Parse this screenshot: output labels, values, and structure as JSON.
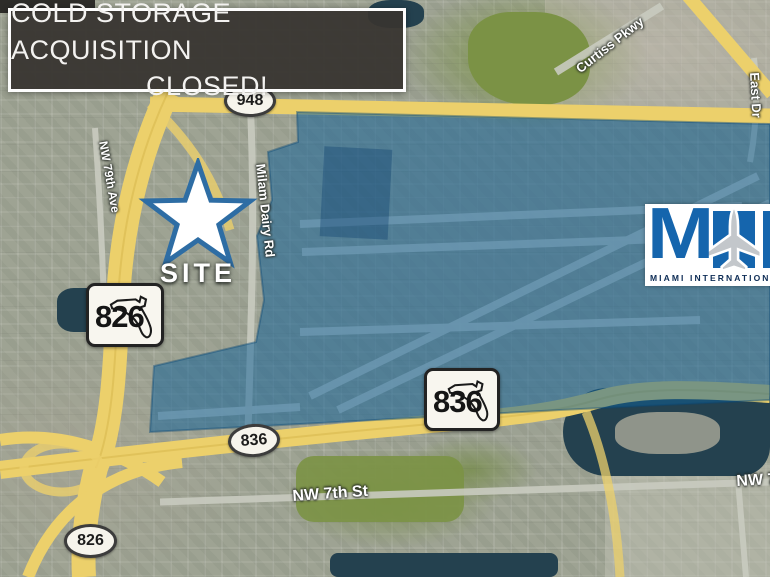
{
  "banner": {
    "line1": "COLD STORAGE ACQUISITION",
    "line2": "CLOSED!"
  },
  "site_marker": {
    "label": "SITE"
  },
  "shields": {
    "oval_948": "948",
    "florida_826": "826",
    "florida_836": "836",
    "oval_836": "836",
    "oval_826": "826"
  },
  "street_labels": {
    "milam_dairy_rd": "Milam Dairy Rd",
    "nw_79th_ave": "NW 79th Ave",
    "curtiss_pkwy": "Curtiss Pkwy",
    "east_dr": "East Dr",
    "nw_7th_st": "NW 7th St",
    "nw_7th_st_right": "NW 7",
    "site": "SITE"
  },
  "airport_logo": {
    "monogram": "M",
    "caption": "MIAMI INTERNATIONAL"
  },
  "colors": {
    "overlay_blue": "#106098",
    "highway_yellow": "#ecd06b",
    "banner_bg": "#383530",
    "logo_blue": "#1565ad",
    "star_outline": "#2e6da4",
    "water": "#24414f"
  }
}
